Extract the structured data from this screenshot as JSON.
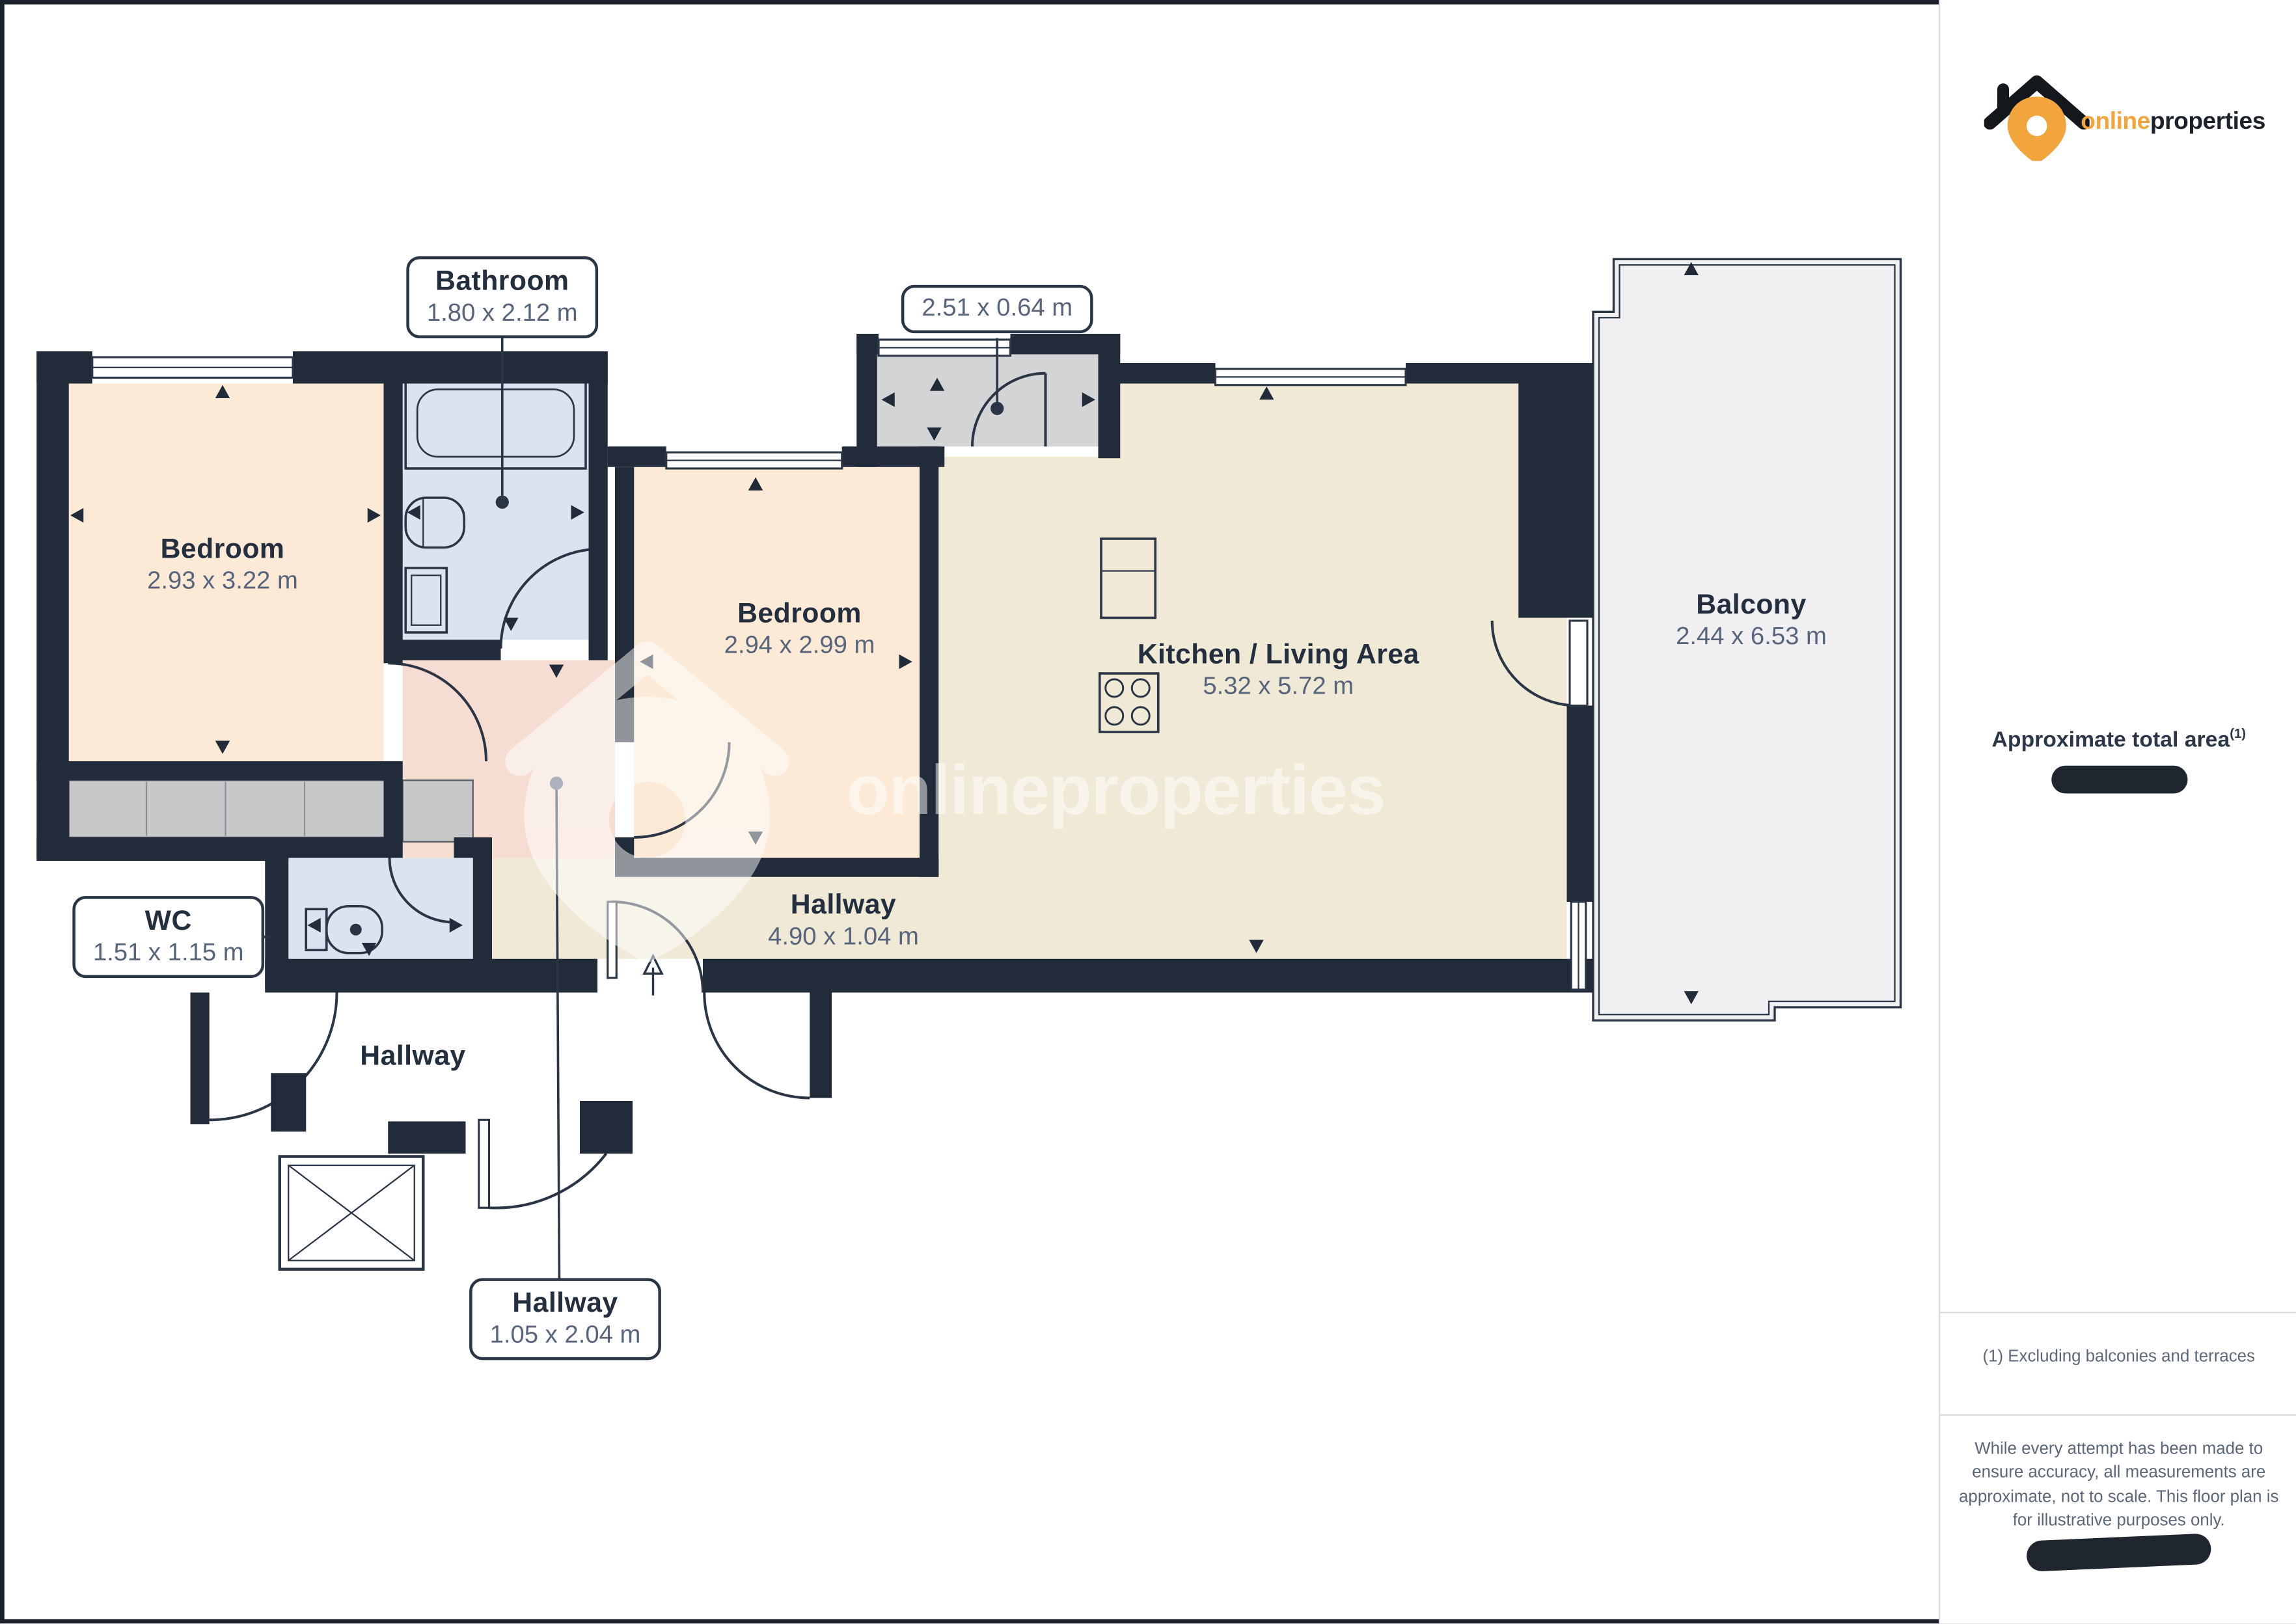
{
  "branding": {
    "logo_online": "online",
    "logo_properties": "properties",
    "accent_orange": "#f2a43d",
    "wall_color": "#212b39"
  },
  "watermark_text": "onlineproperties",
  "rooms": {
    "bedroom1": {
      "name": "Bedroom",
      "dims": "2.93 x 3.22 m"
    },
    "bathroom": {
      "name": "Bathroom",
      "dims": "1.80 x 2.12 m"
    },
    "bedroom2": {
      "name": "Bedroom",
      "dims": "2.94 x 2.99 m"
    },
    "storage": {
      "dims": "2.51 x 0.64 m"
    },
    "kitchen_living": {
      "name": "Kitchen / Living Area",
      "dims": "5.32 x 5.72 m"
    },
    "balcony": {
      "name": "Balcony",
      "dims": "2.44 x 6.53 m"
    },
    "wc": {
      "name": "WC",
      "dims": "1.51 x 1.15 m"
    },
    "hallway_main": {
      "name": "Hallway",
      "dims": "4.90 x 1.04 m"
    },
    "hallway_entry": {
      "name": "Hallway",
      "dims": "1.05 x 2.04 m"
    },
    "hallway_common": {
      "name": "Hallway"
    }
  },
  "sidebar": {
    "area_label": "Approximate total area",
    "area_footnote_marker": "(1)",
    "footnote": "(1) Excluding balconies and terraces",
    "disclaimer": "While every attempt has been made to ensure accuracy, all measurements are approximate, not to scale. This floor plan is for illustrative purposes only."
  }
}
